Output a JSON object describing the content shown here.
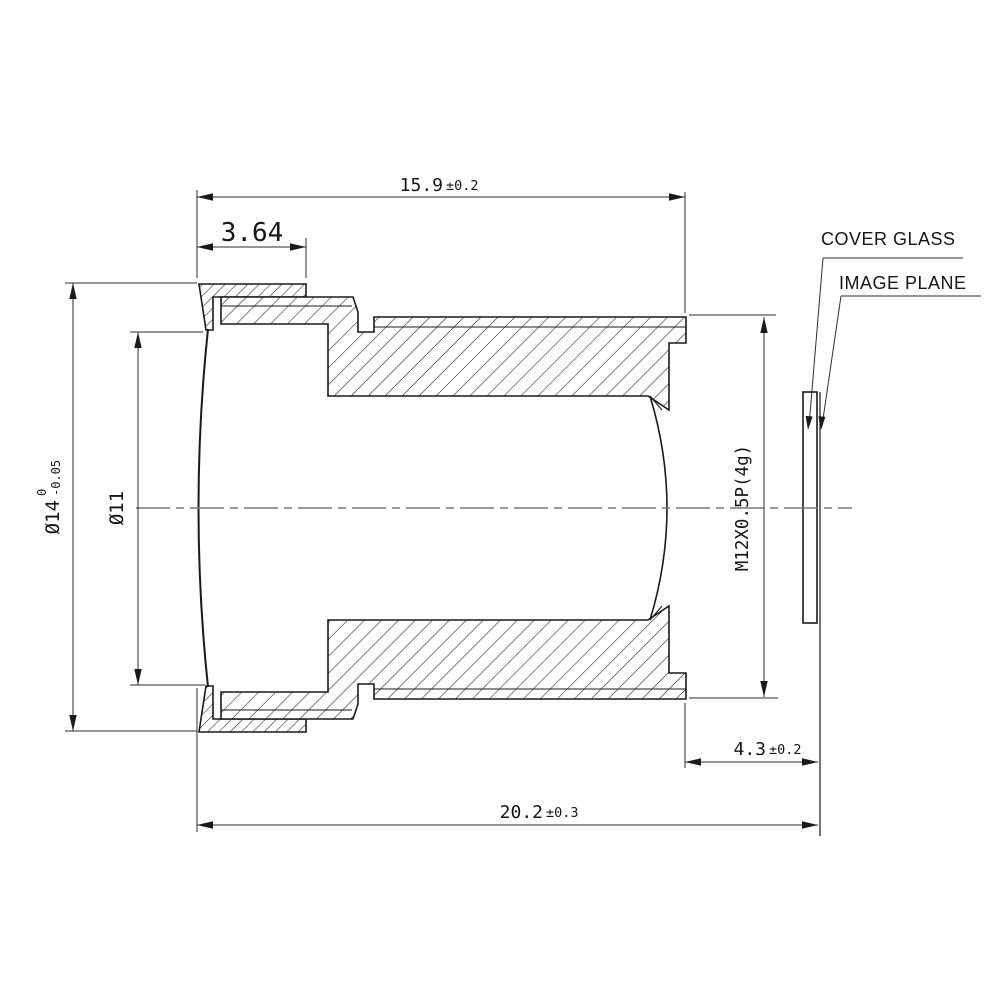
{
  "drawing": {
    "labels": {
      "cover_glass": "COVER GLASS",
      "image_plane": "IMAGE PLANE"
    },
    "dims": {
      "barrel_length": {
        "value": "15.9",
        "tol": "±0.2"
      },
      "front_ring": {
        "value": "3.64"
      },
      "total_length": {
        "value": "20.2",
        "tol": "±0.3"
      },
      "back_focal": {
        "value": "4.3",
        "tol": "±0.2"
      },
      "outer_diameter": {
        "value": "Ø14",
        "tol_upper": "0",
        "tol_lower": "-0.05"
      },
      "clear_aperture": {
        "value": "Ø11"
      },
      "thread": {
        "value": "M12X0.5P(4g)"
      }
    },
    "colors": {
      "line": "#1a1a1a",
      "dimension_line": "#2e2e2e",
      "centerline": "#777777",
      "background": "#ffffff"
    }
  }
}
